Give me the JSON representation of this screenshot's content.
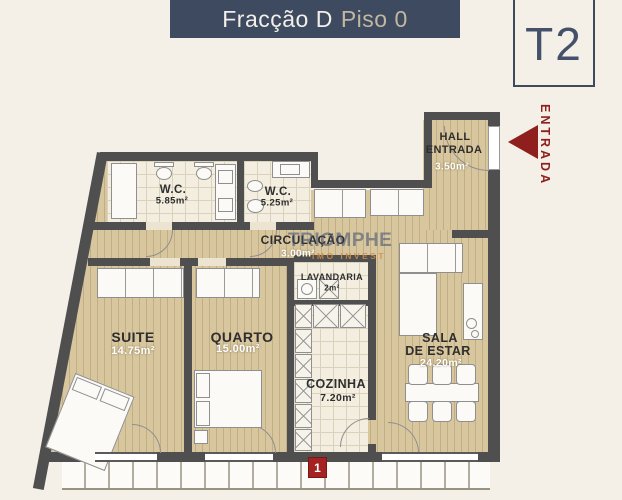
{
  "header": {
    "title": "Fracção D",
    "subtitle": "Piso 0"
  },
  "badge": {
    "label": "T2"
  },
  "entrance": {
    "label": "ENTRADA"
  },
  "watermark": {
    "line1": "TRIOMPHE",
    "line2": "IMO INVEST"
  },
  "unit_marker": {
    "label": "1"
  },
  "rooms": {
    "wc1": {
      "name": "W.C.",
      "area": "5.85m²"
    },
    "wc2": {
      "name": "W.C.",
      "area": "5.25m²"
    },
    "circulacao": {
      "name": "CIRCULAÇÃO",
      "area": "3.00m²"
    },
    "lavandaria": {
      "name": "LAVANDARIA",
      "area": "2m²"
    },
    "hall": {
      "name_line1": "HALL",
      "name_line2": "ENTRADA",
      "area": "3.50m²"
    },
    "suite": {
      "name": "SUITE",
      "area": "14.75m²"
    },
    "quarto": {
      "name": "QUARTO",
      "area": "15.00m²"
    },
    "cozinha": {
      "name": "COZINHA",
      "area": "7.20m²"
    },
    "sala": {
      "name_line1": "SALA",
      "name_line2": "DE ESTAR",
      "area": "24.20m²"
    }
  },
  "colors": {
    "wall": "#4f4f4f",
    "navy": "#3d4a5f",
    "gold": "#c3b7a0",
    "red": "#8e1f1c"
  }
}
